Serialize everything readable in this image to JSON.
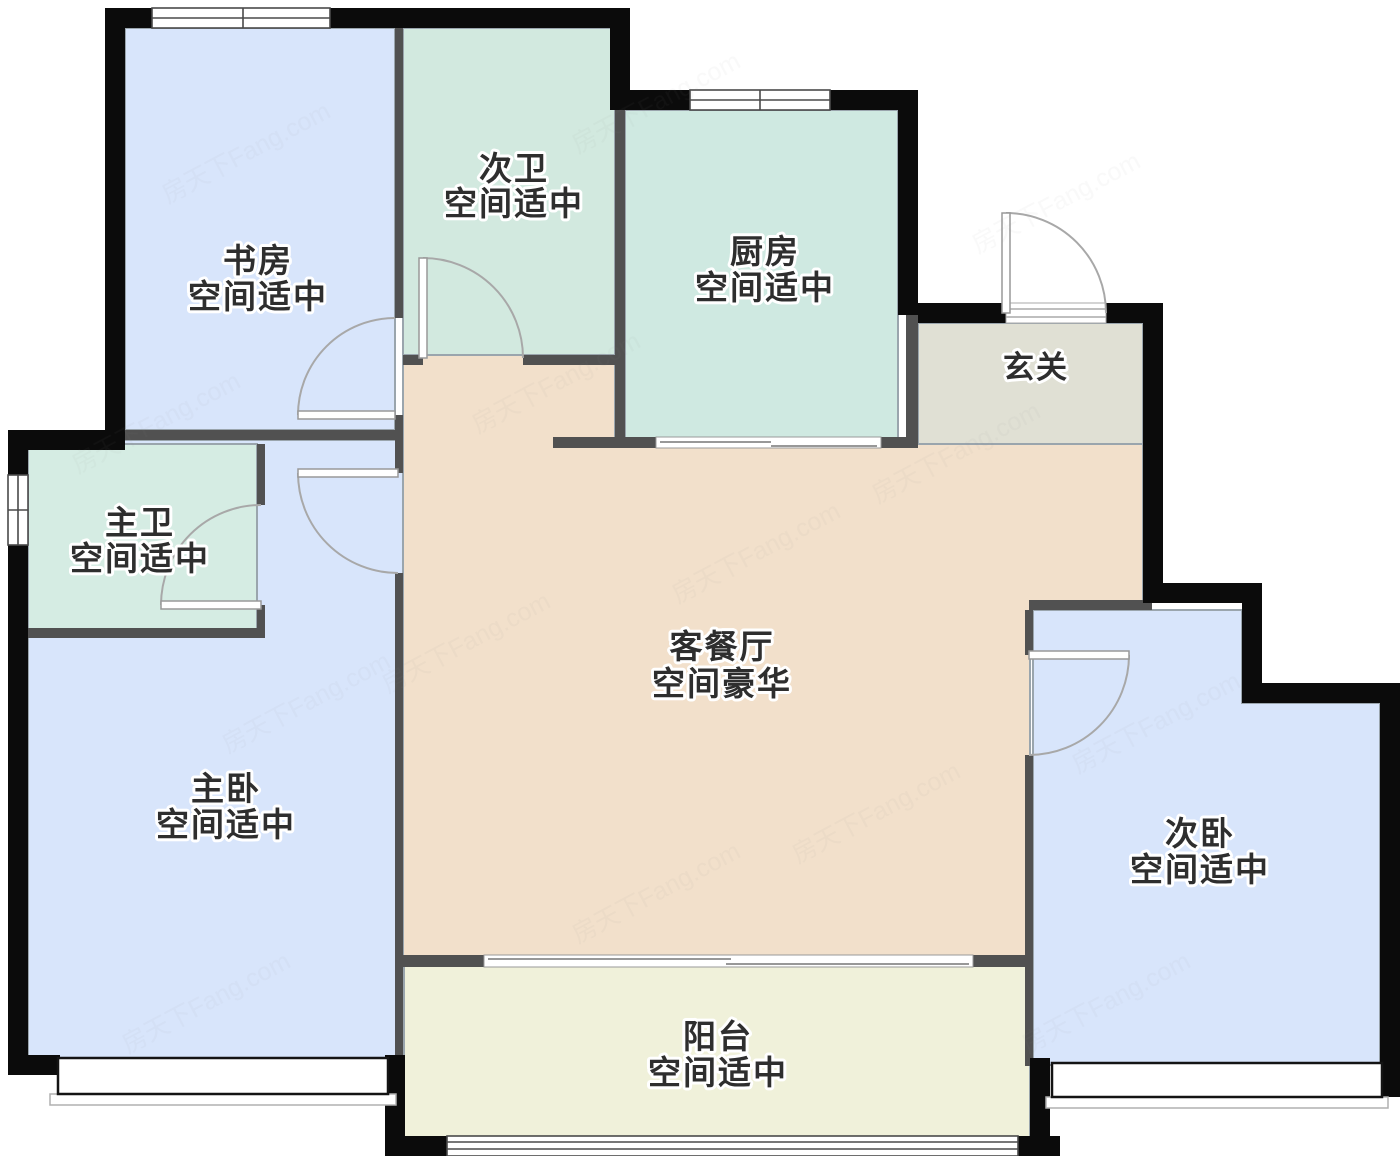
{
  "title": "户型图",
  "watermark": "房天下Fang.com",
  "rooms": [
    {
      "id": "study",
      "name": "书房",
      "desc": "空间适中",
      "color": "#d8e5fb"
    },
    {
      "id": "bath2",
      "name": "次卫",
      "desc": "空间适中",
      "color": "#d2e9df"
    },
    {
      "id": "kitchen",
      "name": "厨房",
      "desc": "空间适中",
      "color": "#cfe9e1"
    },
    {
      "id": "foyer",
      "name": "玄关",
      "desc": "",
      "color": "#e0e0d4"
    },
    {
      "id": "living",
      "name": "客餐厅",
      "desc": "空间豪华",
      "color": "#f2e0cb"
    },
    {
      "id": "bath1",
      "name": "主卫",
      "desc": "空间适中",
      "color": "#d5ece3"
    },
    {
      "id": "master",
      "name": "主卧",
      "desc": "空间适中",
      "color": "#d8e5fb"
    },
    {
      "id": "bed2",
      "name": "次卧",
      "desc": "空间适中",
      "color": "#d8e5fb"
    },
    {
      "id": "balcony",
      "name": "阳台",
      "desc": "空间适中",
      "color": "#f0f1da"
    }
  ],
  "colors": {
    "background": "#ffffff",
    "wall_exterior": "#0b0b0b",
    "wall_interior": "#515151",
    "window_line": "#4a4a4a",
    "door_line": "#a8a8a8",
    "label_text": "#2e2e2e"
  }
}
